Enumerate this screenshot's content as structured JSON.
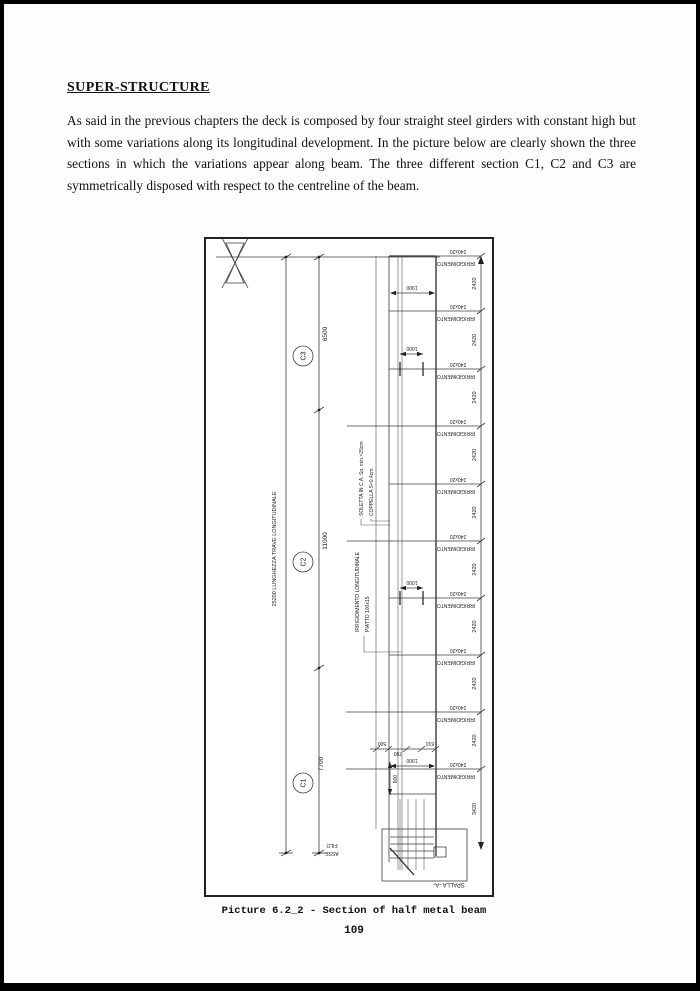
{
  "heading": "SUPER-STRUCTURE",
  "paragraph": "As said in the previous chapters the deck is composed by four straight steel girders with constant high but with some variations along its longitudinal development. In the picture below are clearly shown the three sections in which the variations appear along beam. The three different section C1, C2 and C3 are symmetrically disposed with respect to the centreline of the beam.",
  "caption": "Picture 6.2_2 - Section of half metal beam",
  "page_number": "109",
  "figure": {
    "total_label": "25200  LUNGHEZZA TRAVE LONGITUDINALE",
    "sections": [
      {
        "id": "C3",
        "length": "6500"
      },
      {
        "id": "C2",
        "length": "11000"
      },
      {
        "id": "C1",
        "length": "7700"
      }
    ],
    "stiffener": {
      "size": "240x20",
      "name": "IRRIGIDIMENTO"
    },
    "spacings": [
      "2420",
      "2420",
      "2420",
      "2420",
      "2420",
      "2420",
      "2420",
      "2420",
      "2420",
      "3420"
    ],
    "annotations": {
      "soletta": "SOLETTA IN C.A. Sp. min.=25cm",
      "coppella": "COPPELLA S=0.4cm",
      "irrig_long_1": "IRRIGIDIMENTO LONGITUDINALE",
      "irrig_long_2": "PIATTO 100x15",
      "filo": "FILO",
      "asse": "ASSE",
      "spalla": "SPALLA -A-"
    },
    "dims": {
      "top_width": "1900",
      "hole_spacing_1": "1000",
      "hole_spacing_2": "1000",
      "b500": "500",
      "b790": "790",
      "b610": "610",
      "b1900": "1900",
      "v800": "800"
    }
  }
}
